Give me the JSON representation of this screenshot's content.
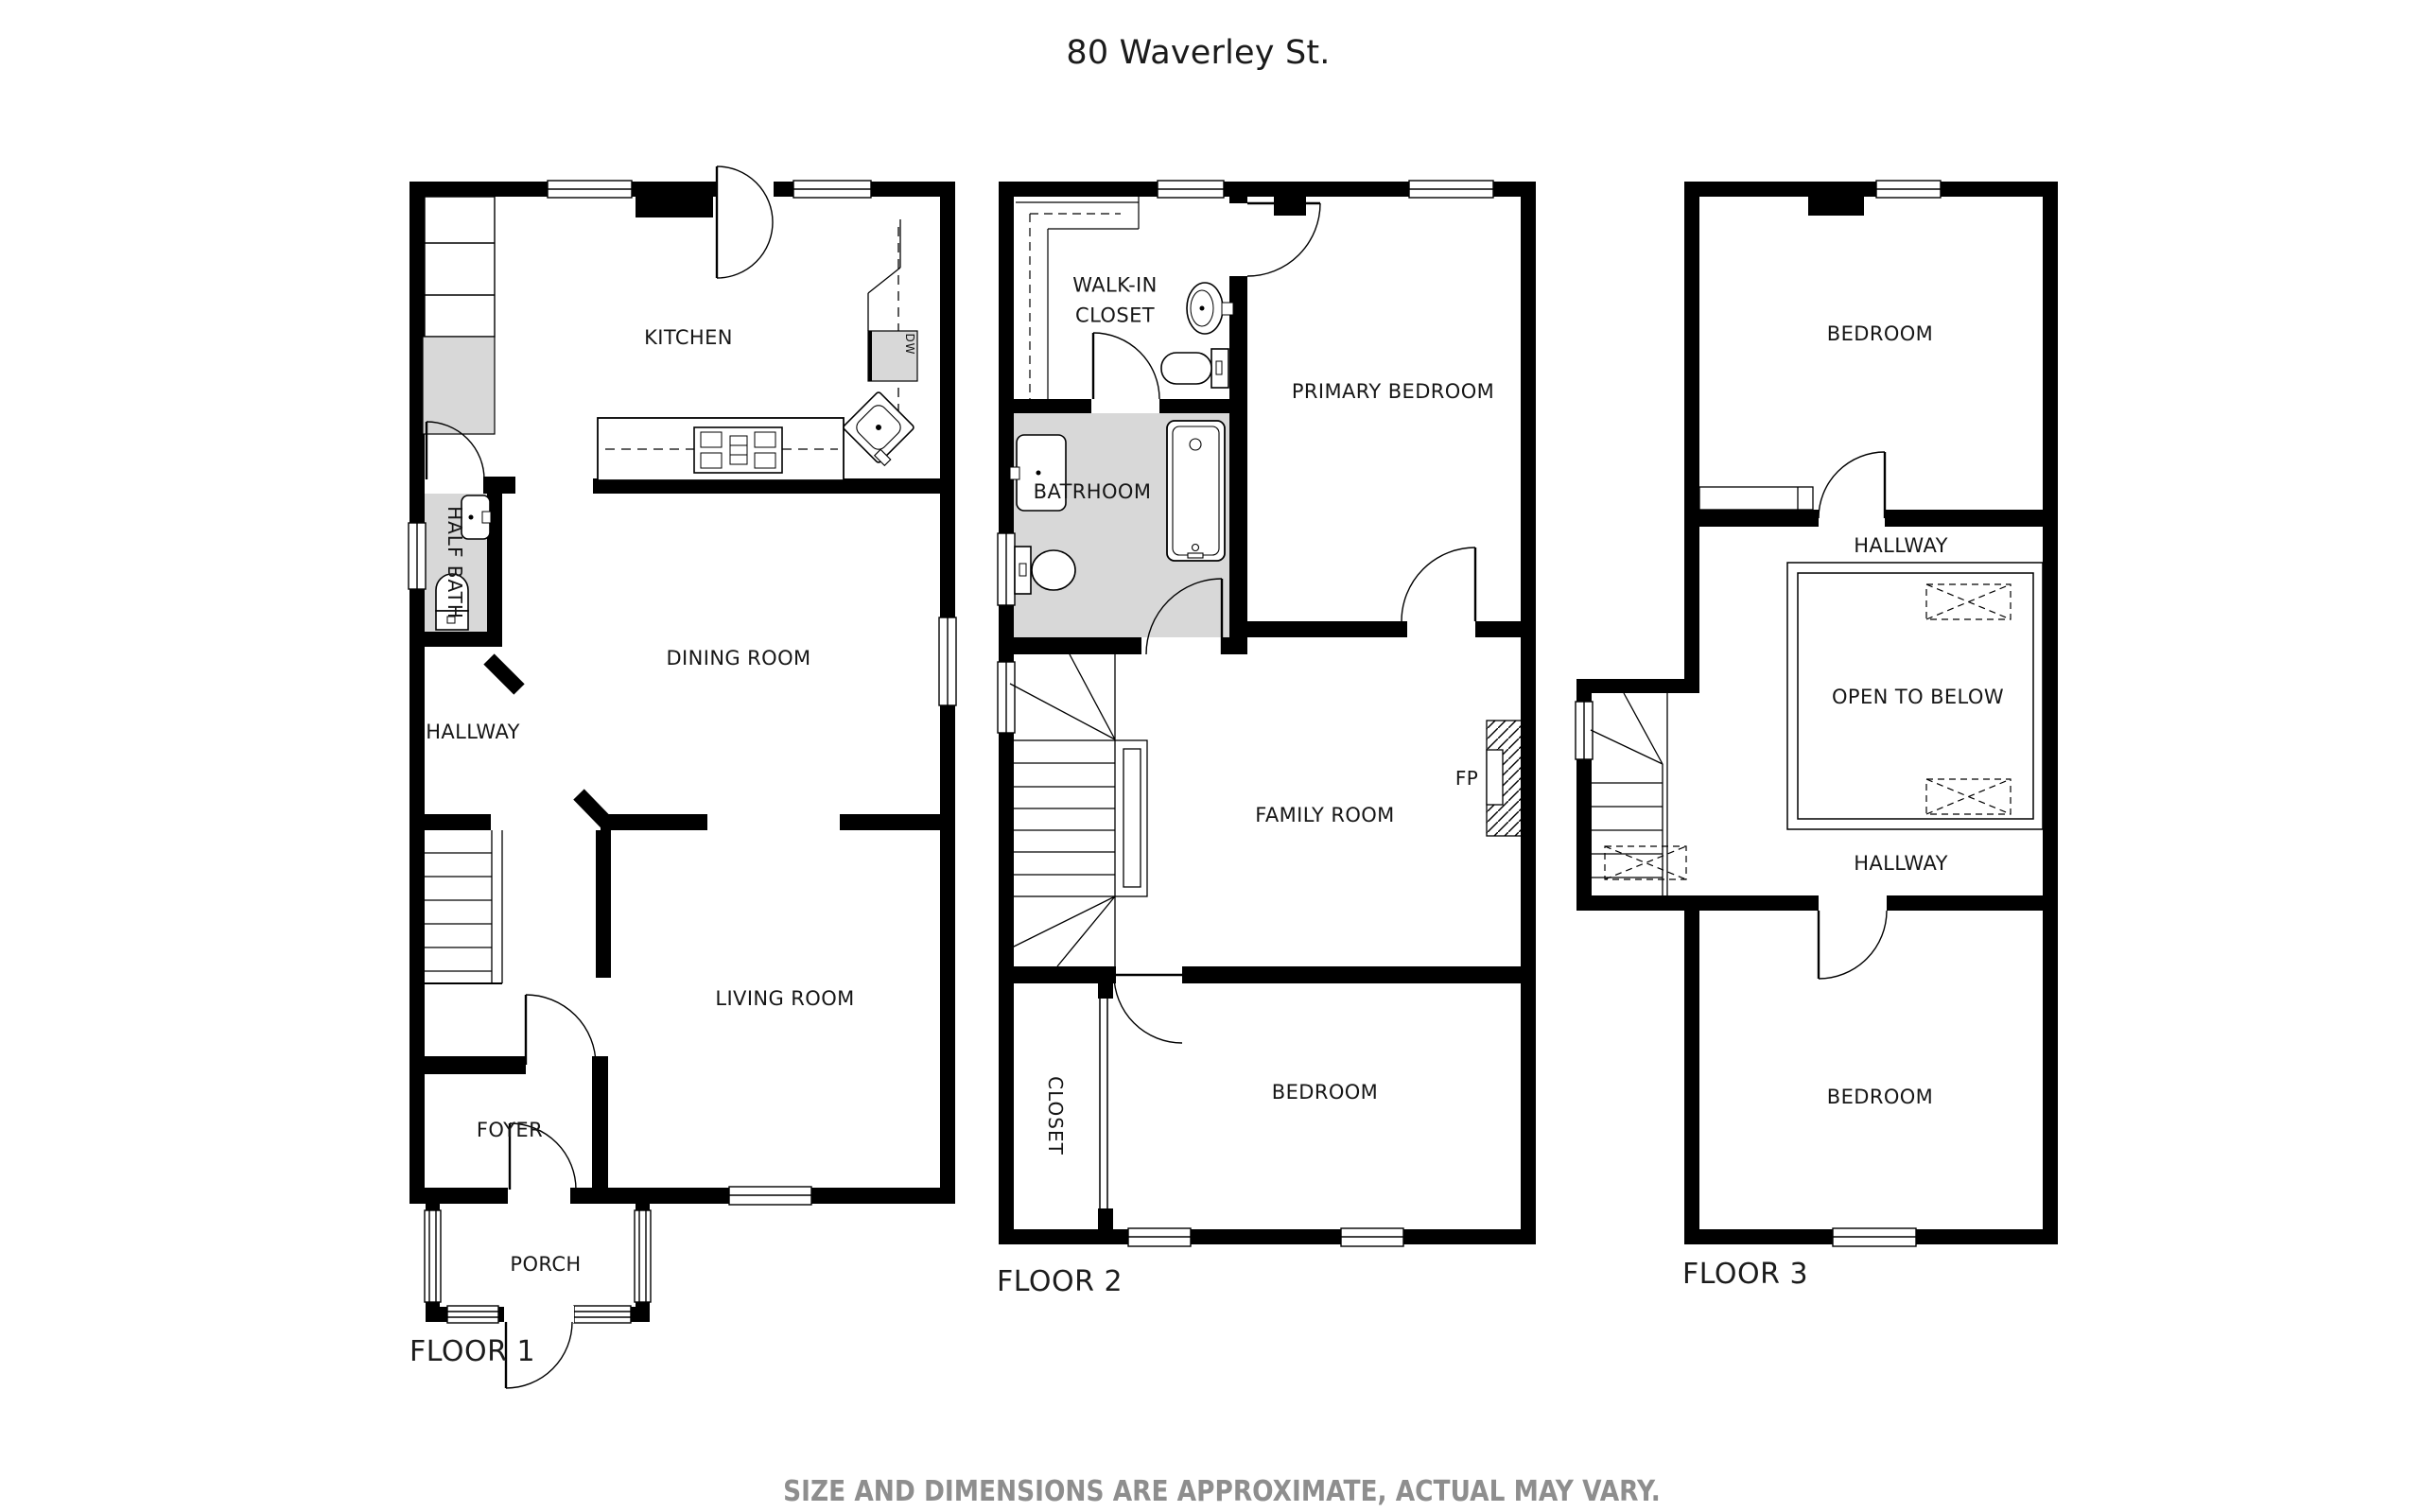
{
  "title": "80 Waverley St.",
  "disclaimer": "SIZE AND DIMENSIONS ARE APPROXIMATE, ACTUAL MAY VARY.",
  "colors": {
    "walls": "#000000",
    "fixture_fill": "#d8d8d8",
    "label_text": "#161616",
    "disclaimer_text": "#8e8e8e"
  },
  "floor1": {
    "caption": "FLOOR 1",
    "rooms": {
      "kitchen": "KITCHEN",
      "half_bath": "HALF BATH",
      "dining_room": "DINING ROOM",
      "hallway": "HALLWAY",
      "living_room": "LIVING ROOM",
      "foyer": "FOYER",
      "porch": "PORCH"
    },
    "appliances": {
      "dishwasher": "DW"
    }
  },
  "floor2": {
    "caption": "FLOOR 2",
    "rooms": {
      "walk_in_closet": "WALK-IN CLOSET",
      "bathroom": "BATRHOOM",
      "primary_bedroom": "PRIMARY BEDROOM",
      "family_room": "FAMILY ROOM",
      "closet": "CLOSET",
      "bedroom": "BEDROOM"
    },
    "features": {
      "fireplace": "FP"
    }
  },
  "floor3": {
    "caption": "FLOOR 3",
    "rooms": {
      "bedroom_top": "BEDROOM",
      "hallway_top": "HALLWAY",
      "open_to_below": "OPEN TO BELOW",
      "hallway_bottom": "HALLWAY",
      "bedroom_bottom": "BEDROOM"
    }
  }
}
